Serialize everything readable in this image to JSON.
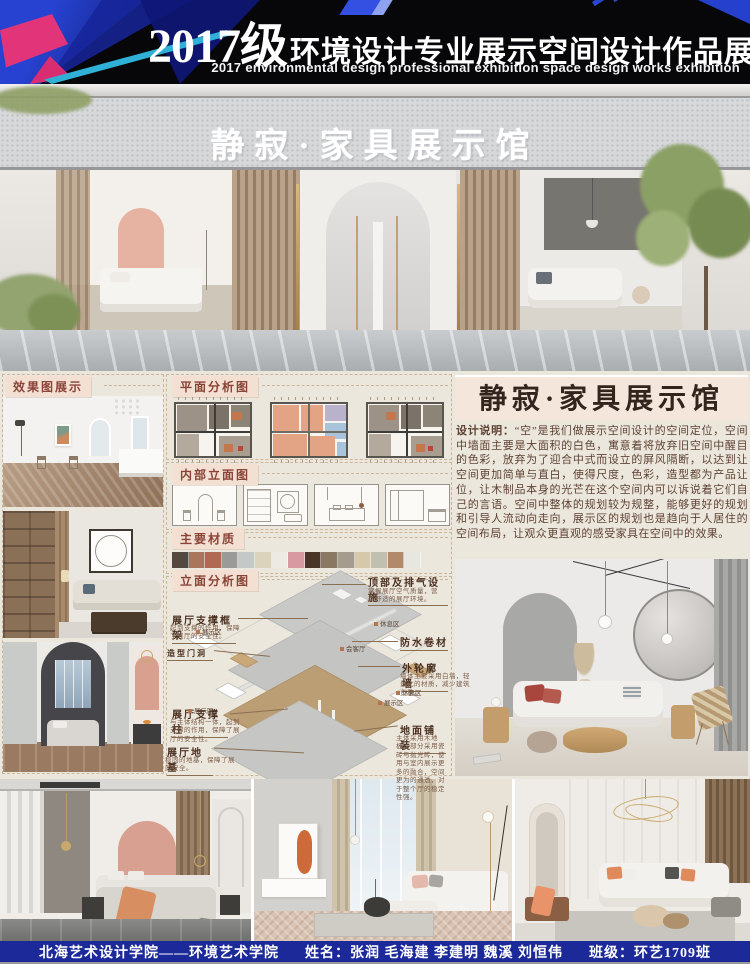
{
  "header": {
    "title_year": "2017级",
    "title_cn": "环境设计专业展示空间设计作品展",
    "subtitle_en": "2017 environmental design professional exhibition space design works exhibition"
  },
  "storefront": {
    "sign_text": "静寂·家具展示馆"
  },
  "panels": {
    "effects_label": "效果图展示",
    "plan_label": "平面分析图",
    "interior_elevation_label": "内部立面图",
    "materials_label": "主要材质",
    "elevation_analysis_label": "立面分析图"
  },
  "materials": {
    "swatches": [
      "#55493f",
      "#a9755b",
      "#b26952",
      "#9a9a98",
      "#c4c8c7",
      "#dcd3bd",
      "#edeae3",
      "#d89aa0",
      "#4a3526",
      "#8b7862",
      "#a59c8f",
      "#d6c8ab",
      "#c1bfb0",
      "#b18a6b",
      "#e8e6e0"
    ]
  },
  "axon": {
    "ann": {
      "vent": {
        "label": "顶部及排气设施",
        "note": "掌握展厅空气质量，营造舒适的展厅环境。"
      },
      "frame": {
        "label": "展厅支撑框架",
        "note": "起到支撑的作用，保障了展厅的安全性。"
      },
      "door": {
        "label": "造型门洞",
        "note": ""
      },
      "waterproof": {
        "label": "防水卷材",
        "note": ""
      },
      "wall": {
        "label": "外轮廓墙",
        "note": "墙体主要采用白墙，轻量化的材质，减少建筑负重。"
      },
      "pillar": {
        "label": "展厅支撑柱",
        "note": "与主体结构一体，起到支撑的作用，保障了展厅的安全性。"
      },
      "paving": {
        "label": "地面铺装",
        "note": "主体采用木地板，部分采用瓷砖与抛光砖，使用与室内展示更多的融合，空间更为的通透，对于整个厅的稳定性强。"
      },
      "foundation": {
        "label": "展厅地基",
        "note": "稳固的地基，保障了展厅安全。"
      }
    },
    "tags": {
      "t1": "展示区",
      "t2": "休息区",
      "t3": "会客厅",
      "t4": "休息区",
      "t5": "展示区",
      "t6": "展示区"
    }
  },
  "description": {
    "title": "静寂·家具展示馆",
    "intro_label": "设计说明：",
    "body": "“空”是我们做展示空间设计的空间定位，空间中墙面主要是大面积的白色，寓意着将放弃旧空间中醒目的色彩，放弃为了迎合中式而设立的屏风隔断，以达到让空间更加简单与直白，使得尺度，色彩，造型都为产品让位，让木制品本身的光芒在这个空间内可以诉说着它们自己的言语。空间中整体的规划较为规整，能够更好的规划和引导人流动向走向，展示区的规划也是趋向于人居住的空间布局，让观众更直观的感受家具在空间中的效果。"
  },
  "footer": {
    "school": "北海艺术设计学院——环境艺术学院",
    "names_label": "姓名：",
    "names": "张润 毛海建 李建明 魏溪 刘恒伟",
    "class_label": "班级：",
    "class_value": "环艺1709班"
  },
  "colors": {
    "header_bg": "#070709",
    "footer_bg": "#1c2a99",
    "section_bg": "#ece7dd",
    "label_bg": "#f4dfd3",
    "label_text": "#8a4437",
    "desc_text": "#5e4234",
    "accent_pink": "#e23579",
    "accent_blue": "#2440cc"
  }
}
